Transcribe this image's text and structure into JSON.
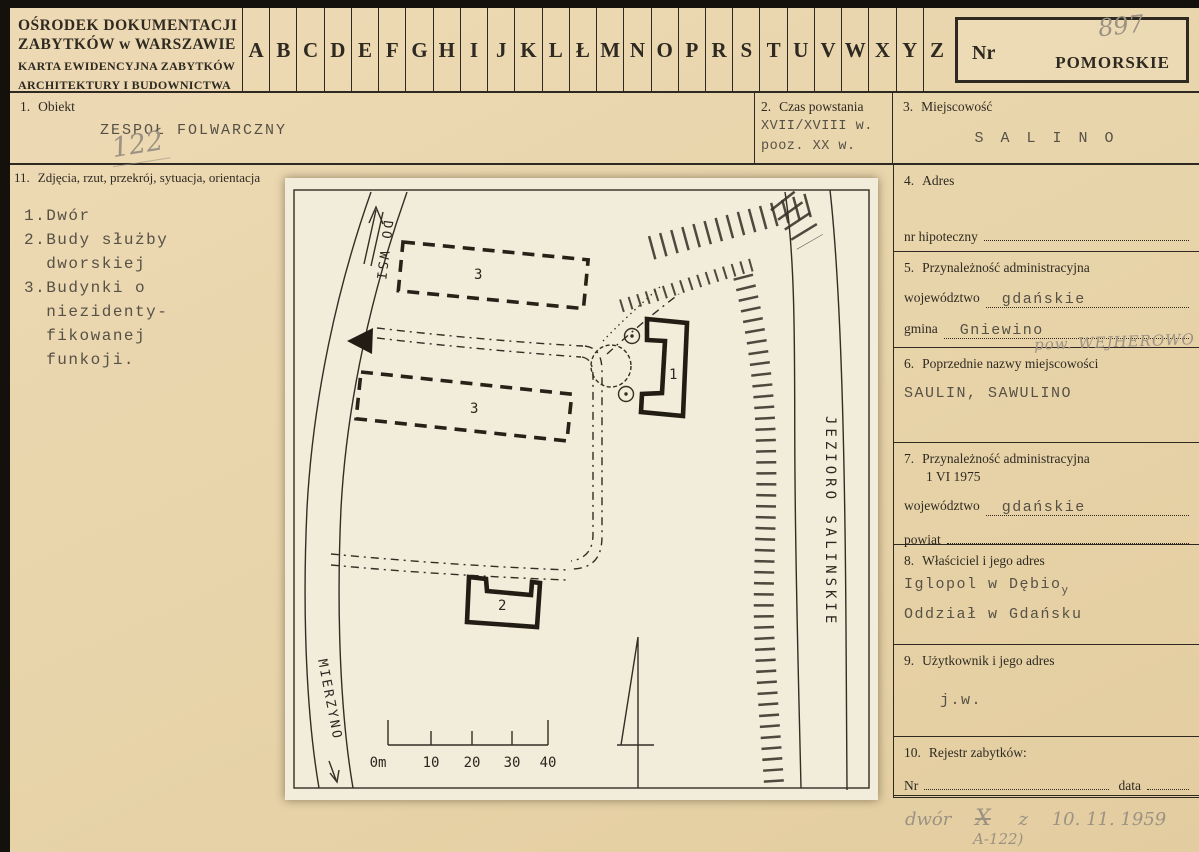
{
  "header": {
    "org_line1": "OŚRODEK DOKUMENTACJI",
    "org_line2": "ZABYTKÓW w WARSZAWIE",
    "title_line1": "KARTA EWIDENCYJNA ZABYTKÓW",
    "title_line2": "ARCHITEKTURY I BUDOWNICTWA",
    "alphabet": [
      "A",
      "B",
      "C",
      "D",
      "E",
      "F",
      "G",
      "H",
      "I",
      "J",
      "K",
      "L",
      "Ł",
      "M",
      "N",
      "O",
      "P",
      "R",
      "S",
      "T",
      "U",
      "V",
      "W",
      "X",
      "Y",
      "Z"
    ],
    "nr_label": "Nr",
    "nr_pencil": "897",
    "stamp": "POMORSKIE"
  },
  "f1": {
    "no": "1.",
    "label": "Obiekt",
    "value": "ZESPOŁ FOLWARCZNY",
    "pencil": "122"
  },
  "f2": {
    "no": "2.",
    "label": "Czas powstania",
    "value_line1": "XVII/XVIII w.",
    "value_line2": "pooz. XX w."
  },
  "f3": {
    "no": "3.",
    "label": "Miejscowość",
    "value": "S A L I N O"
  },
  "f11": {
    "no": "11.",
    "label": "Zdjęcia, rzut, przekrój, sytuacja, orientacja",
    "legend": "1.Dwór\n2.Budy służby\n  dworskiej\n3.Budynki o\n  niezidenty-\n  fikowanej\n  funkoji."
  },
  "f4": {
    "no": "4.",
    "label": "Adres",
    "sub_label": "nr hipoteczny"
  },
  "f5": {
    "no": "5.",
    "label": "Przynależność administracyjna",
    "row1_label": "województwo",
    "row1_value": "gdańskie",
    "row2_label": "gmina",
    "row2_value": "Gniewino",
    "pencil": "pow. WEJHEROWO"
  },
  "f6": {
    "no": "6.",
    "label": "Poprzednie nazwy miejscowości",
    "value": "SAULIN, SAWULINO"
  },
  "f7": {
    "no": "7.",
    "label": "Przynależność administracyjna",
    "date": "1 VI 1975",
    "row1_label": "województwo",
    "row1_value": "gdańskie",
    "row2_label": "powiat",
    "row2_value": ""
  },
  "f8": {
    "no": "8.",
    "label": "Właściciel i jego adres",
    "value_line1": "Iglopol w Dębio",
    "value_line1_sub": "y",
    "value_line2": "Oddział w Gdańsku"
  },
  "f9": {
    "no": "9.",
    "label": "Użytkownik i jego adres",
    "value": "j.w."
  },
  "f10": {
    "no": "10.",
    "label": "Rejestr zabytków:",
    "nr_label": "Nr",
    "data_label": "data"
  },
  "registry_pencil": {
    "word": "dwór",
    "crossed": "X",
    "conj": "z",
    "date": "10. 11. 1959",
    "ref": "A-122)"
  },
  "map": {
    "road_top": "DO WSI",
    "road_bottom": "MIERZYNO",
    "lake": "JEZIORO  SALINSKIE",
    "b1": "1",
    "b2": "2",
    "b3a": "3",
    "b3b": "3",
    "scale": [
      "0m",
      "10",
      "20",
      "30",
      "40"
    ]
  }
}
